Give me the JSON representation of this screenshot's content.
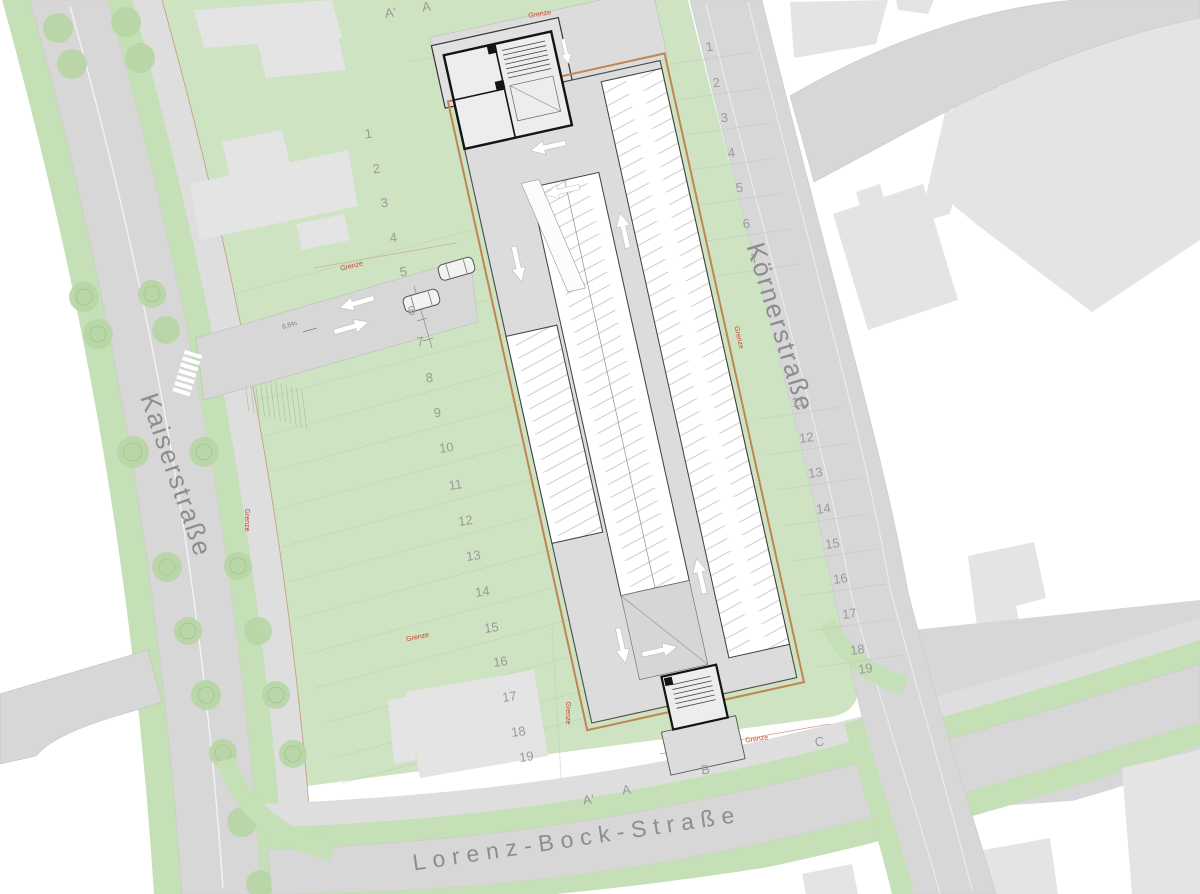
{
  "streets": {
    "kaiser": "Kaiserstraße",
    "koerner": "Körnerstraße",
    "lorenz": "Lorenz-Bock-Straße"
  },
  "boundary_label": "Grenze",
  "slope_label": "6,5%",
  "section_markers": {
    "top": [
      "A'",
      "A"
    ],
    "bottom": [
      "A'",
      "A",
      "B",
      "C"
    ]
  },
  "stall_numbers_left": [
    "1",
    "2",
    "3",
    "4",
    "5",
    "6",
    "7",
    "8",
    "9",
    "10",
    "11",
    "12",
    "13",
    "14",
    "15",
    "16",
    "17",
    "18",
    "19"
  ],
  "stall_numbers_right": [
    "1",
    "2",
    "3",
    "4",
    "5",
    "6",
    "7",
    "11",
    "12",
    "13",
    "14",
    "15",
    "16",
    "17",
    "18",
    "19"
  ],
  "colors": {
    "parcel_green": "#cde3c1",
    "verge_green": "#c5dfb6",
    "road_gray": "#d7d7d7",
    "sidewalk_gray": "#dedede",
    "building_gray": "#e4e4e4",
    "garage_aisle_gray": "#dcdcdc",
    "bay_white": "#ffffff",
    "boundary_orange": "#c08552",
    "grenze_red": "#cc4433",
    "label_gray": "#9a9a9a",
    "tree_green": "#b7d6a5"
  }
}
